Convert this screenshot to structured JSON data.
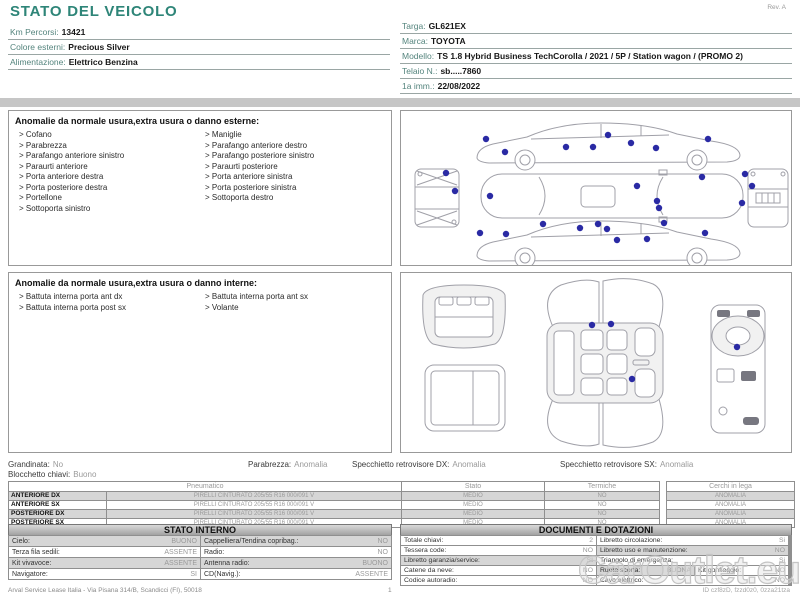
{
  "title": "STATO DEL VEICOLO",
  "rev": "Rev. A",
  "vehicle_info": {
    "left": [
      {
        "label": "Km Percorsi:",
        "value": "13421"
      },
      {
        "label": "Colore esterni:",
        "value": "Precious Silver"
      },
      {
        "label": "Alimentazione:",
        "value": "Elettrico Benzina"
      }
    ],
    "right": [
      {
        "label": "Targa:",
        "value": "GL621EX"
      },
      {
        "label": "Marca:",
        "value": "TOYOTA"
      },
      {
        "label": "Modello:",
        "value": "TS 1.8 Hybrid Business TechCorolla / 2021 / 5P / Station wagon / (PROMO 2)"
      },
      {
        "label": "Telaio N.:",
        "value": "sb.....7860"
      },
      {
        "label": "1a imm.:",
        "value": "22/08/2022"
      }
    ]
  },
  "anomalie_esterne": {
    "header": "Anomalie da normale usura,extra usura o danno esterne:",
    "col1": [
      "Cofano",
      "Parabrezza",
      "Parafango anteriore sinistro",
      "Paraurti anteriore",
      "Porta anteriore destra",
      "Porta posteriore destra",
      "Portellone",
      "Sottoporta sinistro"
    ],
    "col2": [
      "Maniglie",
      "Parafango anteriore destro",
      "Parafango posteriore sinistro",
      "Paraurti posteriore",
      "Porta anteriore sinistra",
      "Porta posteriore sinistra",
      "Sottoporta destro"
    ]
  },
  "anomalie_interne": {
    "header": "Anomalie da normale usura,extra usura o danno interne:",
    "col1": [
      "Battuta interna porta ant dx",
      "Battuta interna porta post sx"
    ],
    "col2": [
      "Battuta interna porta ant sx",
      "Volante"
    ]
  },
  "condition_summary": {
    "grandinata_label": "Grandinata:",
    "grandinata": "No",
    "blocchetto_label": "Blocchetto chiavi:",
    "blocchetto": "Buono",
    "parabrezza_label": "Parabrezza:",
    "parabrezza": "Anomalia",
    "specchietto_dx_label": "Specchietto retrovisore DX:",
    "specchietto_dx": "Anomalia",
    "specchietto_sx_label": "Specchietto retrovisore SX:",
    "specchietto_sx": "Anomalia"
  },
  "tyres": {
    "header_pneumatico": "Pneumatico",
    "header_stato": "Stato",
    "header_termiche": "Termiche",
    "header_cerchi": "Cerchi in lega",
    "rows": [
      {
        "position": "ANTERIORE DX",
        "spec": "PIRELLI CINTURATO 205/55 R16 000/091 V",
        "stato": "MEDIO",
        "termiche": "NO",
        "cerchi": "ANOMALIA"
      },
      {
        "position": "ANTERIORE SX",
        "spec": "PIRELLI CINTURATO 205/55 R16 000/091 V",
        "stato": "MEDIO",
        "termiche": "NO",
        "cerchi": "ANOMALIA"
      },
      {
        "position": "POSTERIORE DX",
        "spec": "PIRELLI CINTURATO 205/55 R16 000/091 V",
        "stato": "MEDIO",
        "termiche": "NO",
        "cerchi": "ANOMALIA"
      },
      {
        "position": "POSTERIORE SX",
        "spec": "PIRELLI CINTURATO 205/55 R16 000/091 V",
        "stato": "MEDIO",
        "termiche": "NO",
        "cerchi": "ANOMALIA"
      }
    ]
  },
  "stato_interno": {
    "title": "STATO INTERNO",
    "rows": [
      [
        {
          "label": "Cielo:",
          "value": "BUONO"
        },
        {
          "label": "Cappelliera/Tendina copribag.:",
          "value": "NO"
        }
      ],
      [
        {
          "label": "Terza fila sedili:",
          "value": "ASSENTE"
        },
        {
          "label": "Radio:",
          "value": "NO"
        }
      ],
      [
        {
          "label": "Kit vivavoce:",
          "value": "ASSENTE"
        },
        {
          "label": "Antenna radio:",
          "value": "BUONO"
        }
      ],
      [
        {
          "label": "Navigatore:",
          "value": "SI"
        },
        {
          "label": "CD(Navig.):",
          "value": "ASSENTE"
        }
      ]
    ]
  },
  "documenti": {
    "title": "DOCUMENTI E DOTAZIONI",
    "rows": [
      [
        {
          "label": "Totale chiavi:",
          "value": "2"
        },
        {
          "label": "Libretto circolazione:",
          "value": "Si"
        }
      ],
      [
        {
          "label": "Tessera code:",
          "value": "NO"
        },
        {
          "label": "Libretto uso e manutenzione:",
          "value": "NO"
        }
      ],
      [
        {
          "label": "Libretto garanzia/service:",
          "value": "SI"
        },
        {
          "label": "Triangolo di emergenza:",
          "value": "Si"
        }
      ],
      [
        {
          "label": "Catene da neve:",
          "value": "NO"
        },
        {
          "label": "Ruota scorta:",
          "value": "BUONA"
        },
        {
          "label": "Kit gonfiaggio:",
          "value": "NO"
        }
      ],
      [
        {
          "label": "Codice autoradio:",
          "value": "NO"
        },
        {
          "label": "Cavo elettrico:",
          "value": "NO"
        }
      ]
    ]
  },
  "footer": {
    "left": "Arval Service Lease Italia - Via Pisana 314/B, Scandicci (FI), 50018",
    "page": "1",
    "doc_id": "ID czf8zD, fzzd0z0, 0zza21tza"
  },
  "watermark": "CarOutlet.eu",
  "diagram": {
    "dot_color": "#2a2aa4",
    "exterior_dots": [
      [
        85,
        28
      ],
      [
        104,
        41
      ],
      [
        165,
        36
      ],
      [
        192,
        36
      ],
      [
        207,
        24
      ],
      [
        230,
        32
      ],
      [
        255,
        37
      ],
      [
        307,
        28
      ],
      [
        45,
        62
      ],
      [
        54,
        80
      ],
      [
        89,
        85
      ],
      [
        236,
        75
      ],
      [
        256,
        90
      ],
      [
        258,
        97
      ],
      [
        301,
        66
      ],
      [
        344,
        63
      ],
      [
        351,
        75
      ],
      [
        341,
        92
      ],
      [
        79,
        122
      ],
      [
        105,
        123
      ],
      [
        142,
        113
      ],
      [
        179,
        117
      ],
      [
        197,
        113
      ],
      [
        206,
        118
      ],
      [
        216,
        129
      ],
      [
        246,
        128
      ],
      [
        263,
        112
      ],
      [
        304,
        122
      ]
    ],
    "interior_dots": [
      [
        191,
        52
      ],
      [
        210,
        51
      ],
      [
        231,
        106
      ],
      [
        336,
        74
      ]
    ]
  }
}
